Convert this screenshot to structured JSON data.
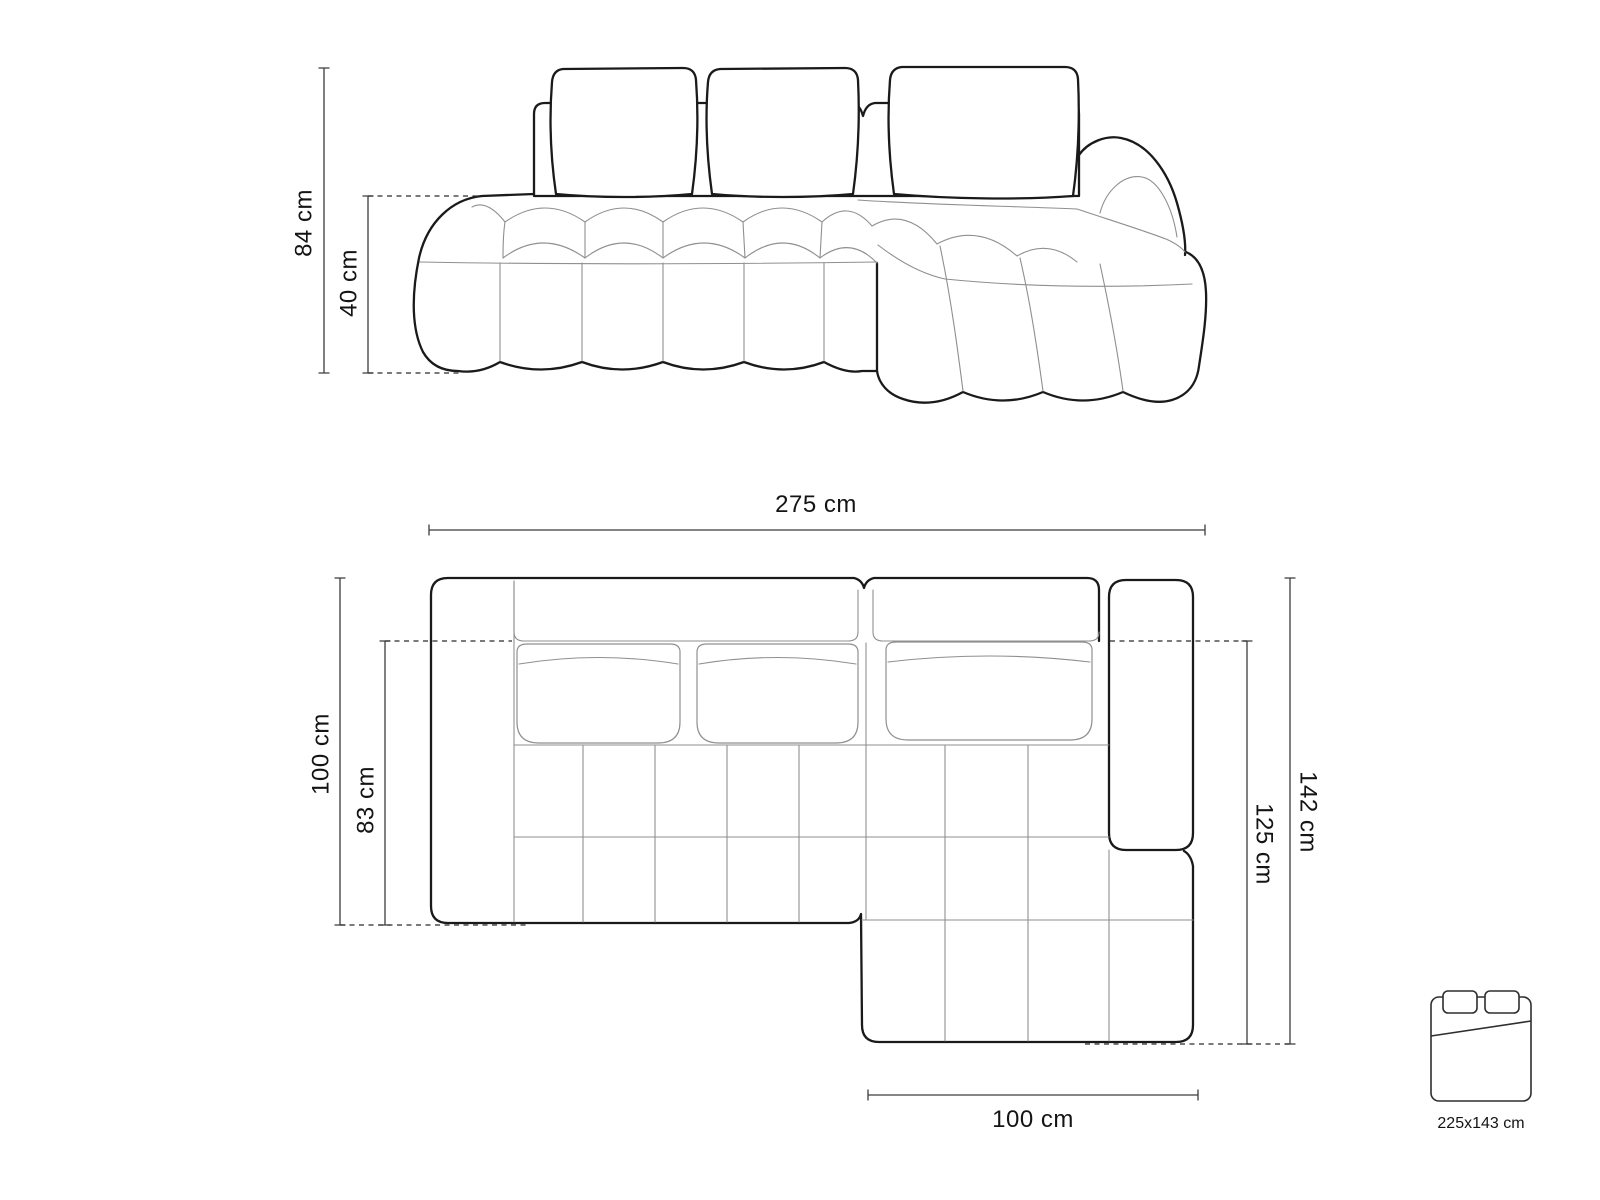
{
  "front_view": {
    "total_height": "84 cm",
    "seat_height": "40 cm"
  },
  "top_view": {
    "total_width": "275 cm",
    "total_depth": "100 cm",
    "seat_depth": "83 cm",
    "side_length_total": "142 cm",
    "side_length_inner": "125 cm",
    "chaise_width": "100 cm"
  },
  "sleeping_area": {
    "size_label": "225x143 cm"
  },
  "colors": {
    "outline": "#1a1a1a",
    "seam": "#8f8f8f",
    "dimension_line": "#3c3c3c",
    "label_text": "#141414",
    "background": "#ffffff"
  }
}
